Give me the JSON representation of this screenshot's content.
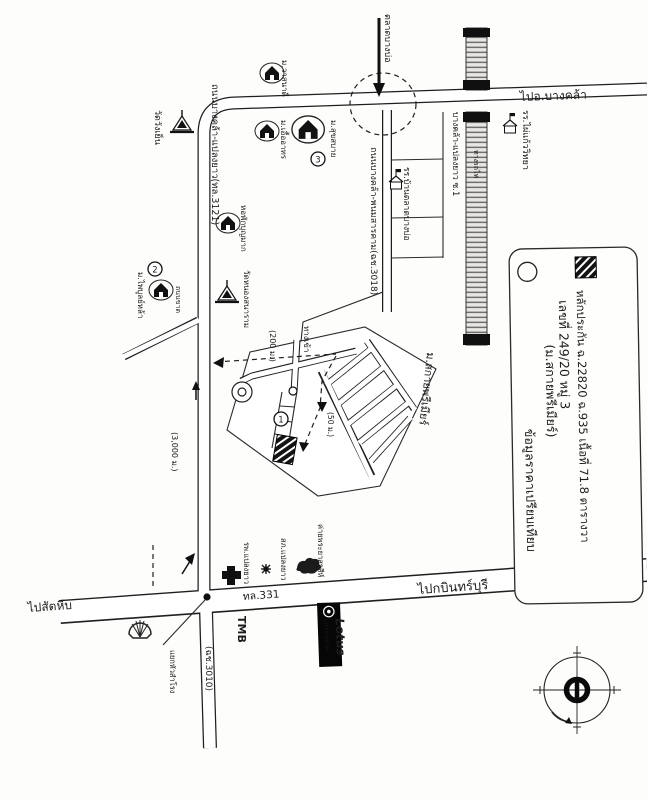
{
  "legend": {
    "line1": "หลักประกัน ฉ.22820 ฉ.935 เนื้อที่ 71.8 ตารางวา",
    "line2": "เลขที่ 249/20 หมู่ 3",
    "line3": "(ม.สกายพรีเมียร์)",
    "line4": "ข้อมูลราคาเปรียบเทียบ"
  },
  "roads": {
    "to_bangkhla": "ไปอ.บางคล้า",
    "tl3121": "ถนนบางคล้า-แปลงยาว(ทล.3121)",
    "cc3018": "ถนนบางคล้า-พนมสารคาม(ฉช.3018)",
    "soi1": "บางคล้า-แปลงยาว ซ.1",
    "railway": "ทางรถไฟ",
    "tl331": "ทล.331",
    "to_kabinburi": "ไปกบินทร์บุรี",
    "to_sattahip": "ไปสัตหีบ",
    "cc3010": "(ฉช.3010)",
    "hua_samrong": "แยกหัวสำโรง",
    "thanon_khat": "ถนนขาด"
  },
  "places": {
    "market": "ตลาดบางบ่อ",
    "school_taladbangbo": "รร.บ้านตลาดบางบ่อ",
    "school_phaikaew": "รร.ไผ่แก้ววิทยา",
    "wat_wangyen": "วัดวังเย็น",
    "wat_nong": "วัดหนองสนาราม",
    "mu_wasanadee": "ม.วาสนาดี",
    "mu_uea": "ม.เอื้ออาทร",
    "mu_suk": "ม.สุขสบาย",
    "dorm": "หอพักบุญมาก",
    "mu_phai": "ม.ไพบูลย์หล้า",
    "estate": "ม.สกายพรีเมียร์",
    "hospital": "รพ.แปลงยาว",
    "police": "สภ.แปลงยาว",
    "camp": "ค่ายพระยาสุรสีห์",
    "tmb": "TMB",
    "lotus": "Lotus",
    "lotus_sub": "SUPERCENTER"
  },
  "route": {
    "entrance": "ทางเข้า",
    "d200": "(200 ม.)",
    "d50": "(50 ม.)",
    "d3000": "(3,000 ม.)"
  },
  "markers": {
    "c1": "1",
    "c2": "2",
    "c3": "3"
  },
  "colors": {
    "ink": "#1f1f1f",
    "paper": "#fdfdfc"
  }
}
